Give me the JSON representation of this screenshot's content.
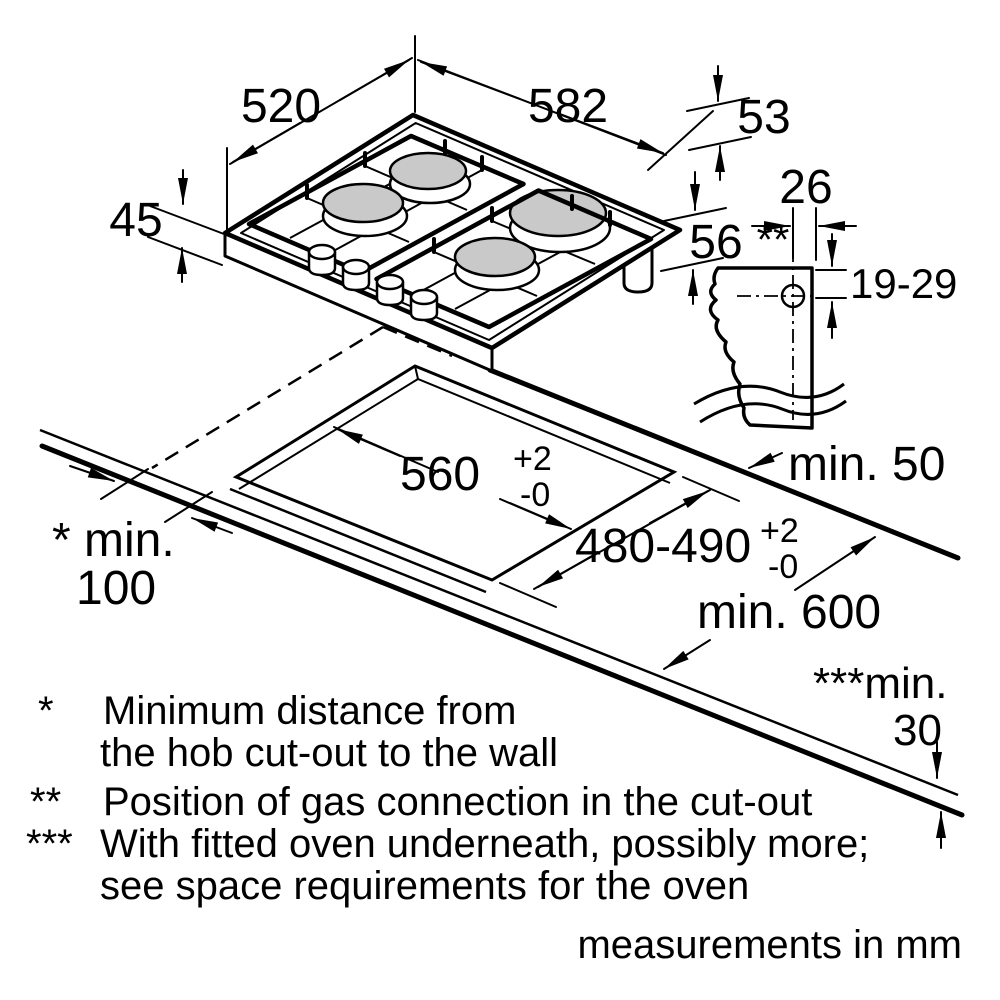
{
  "page": {
    "background": "#ffffff",
    "ink": "#000000",
    "burner_gray": "#c9c9c9",
    "description": "Gas hob installation dimension diagram"
  },
  "dims": {
    "hob_depth": "520",
    "hob_width": "582",
    "rim_edge": "53",
    "height_above_counter": "45",
    "total_height": "56",
    "gas_offset": "26",
    "gas_marker": "**",
    "gas_vertical": "19-29",
    "cut_width": {
      "value": "560",
      "tol_plus": "+2",
      "tol_minus": "-0"
    },
    "cut_depth": {
      "value": "480-490",
      "tol_plus": "+2",
      "tol_minus": "-0"
    },
    "wall_clearance": "min. 50",
    "side_clearance_label": "* min.",
    "side_clearance_value": "100",
    "counter_depth": "min. 600",
    "oven_clearance_label": "***min.",
    "oven_clearance_value": "30"
  },
  "footnotes": {
    "f1_symbol": "*",
    "f1_line1": "Minimum distance from",
    "f1_line2": "the hob cut-out to the wall",
    "f2_symbol": "**",
    "f2_line1": "Position of gas connection in the cut-out",
    "f3_symbol": "***",
    "f3_line1": "With fitted oven underneath, possibly more;",
    "f3_line2": "see space requirements for the oven"
  },
  "units_note": "measurements in mm"
}
